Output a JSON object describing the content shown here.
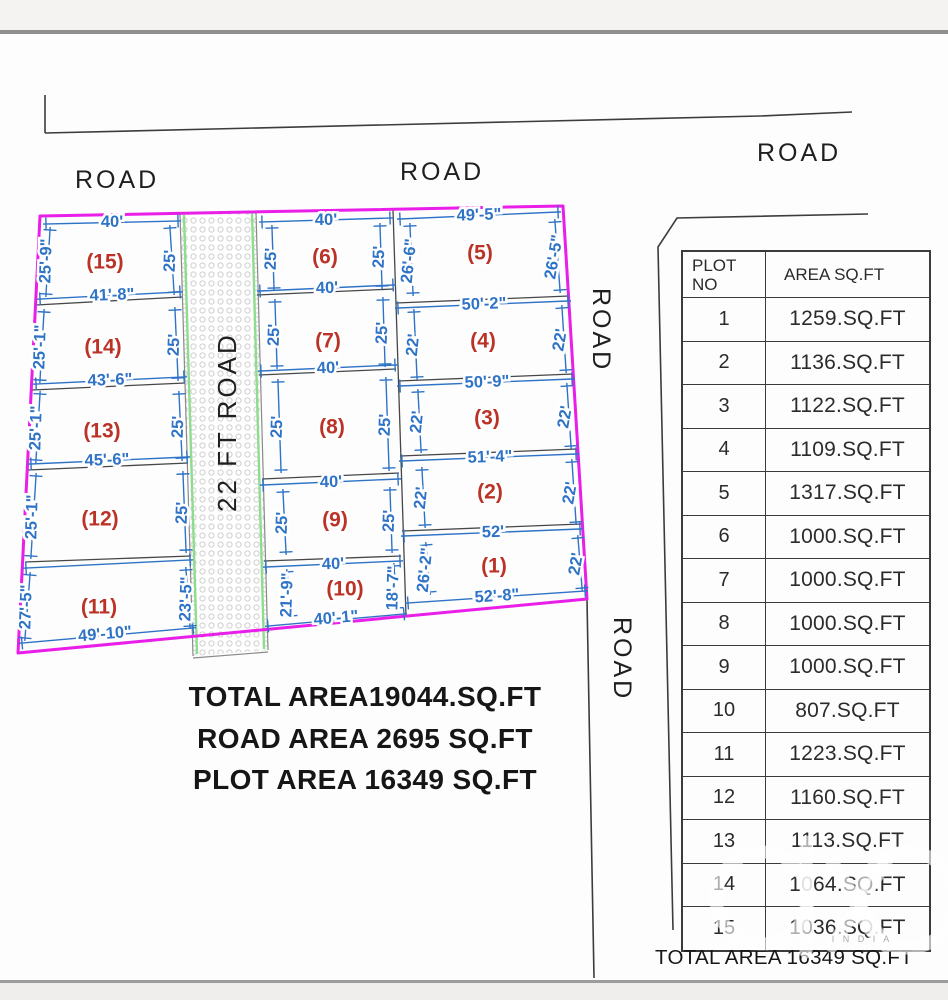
{
  "plan": {
    "road_labels": {
      "top_left": "ROAD",
      "top_center": "ROAD",
      "top_right": "ROAD",
      "right_upper": "ROAD",
      "right_lower": "ROAD",
      "central": "22 FT ROAD"
    },
    "plot_numbers": {
      "p1": "(1)",
      "p2": "(2)",
      "p3": "(3)",
      "p4": "(4)",
      "p5": "(5)",
      "p6": "(6)",
      "p7": "(7)",
      "p8": "(8)",
      "p9": "(9)",
      "p10": "(10)",
      "p11": "(11)",
      "p12": "(12)",
      "p13": "(13)",
      "p14": "(14)",
      "p15": "(15)"
    },
    "dims": {
      "p15_top": "40'",
      "p15_left": "25'-9\"",
      "p15_right": "25'",
      "p15_bottom": "41'-8\"",
      "p14_left": "25'-1\"",
      "p14_right": "25'",
      "p14_bottom": "43'-6\"",
      "p13_left": "25'-1\"",
      "p13_right": "25'",
      "p13_bottom": "45'-6\"",
      "p12_left": "25'-1\"",
      "p12_right": "25'",
      "p11_left": "27'-5\"",
      "p11_right": "23'-5\"",
      "p11_bottom": "49'-10\"",
      "p6_top": "40'",
      "p6_left": "25'",
      "p6_right": "25'",
      "p6_bottom": "40'",
      "p7_left": "25'",
      "p7_right": "25'",
      "p7_bottom": "40'",
      "p8_left": "25'",
      "p8_right": "25'",
      "p8_bottom": "40'",
      "p9_left": "25'",
      "p9_right": "25'",
      "p9_bottom": "40'",
      "p10_left": "21'-9\"",
      "p10_right": "18'-7\"",
      "p10_bottom": "40'-1\"",
      "p5_top": "49'-5\"",
      "p5_left": "26'-6\"",
      "p5_right": "26'-5\"",
      "p5_bottom": "50'-2\"",
      "p4_left": "22'",
      "p4_right": "22'",
      "p4_bottom": "50'-9\"",
      "p3_left": "22'",
      "p3_right": "22'",
      "p3_bottom": "51'-4\"",
      "p2_left": "22'",
      "p2_right": "22'",
      "p2_bottom": "52'",
      "p1_left": "26'-2\"",
      "p1_right": "22'",
      "p1_bottom": "52'-8\""
    }
  },
  "table": {
    "header": {
      "col1": "PLOT NO",
      "col2": "AREA SQ.FT"
    },
    "rows": [
      {
        "no": "1",
        "area": "1259.SQ.FT"
      },
      {
        "no": "2",
        "area": "1136.SQ.FT"
      },
      {
        "no": "3",
        "area": "1122.SQ.FT"
      },
      {
        "no": "4",
        "area": "1109.SQ.FT"
      },
      {
        "no": "5",
        "area": "1317.SQ.FT"
      },
      {
        "no": "6",
        "area": "1000.SQ.FT"
      },
      {
        "no": "7",
        "area": "1000.SQ.FT"
      },
      {
        "no": "8",
        "area": "1000.SQ.FT"
      },
      {
        "no": "9",
        "area": "1000.SQ.FT"
      },
      {
        "no": "10",
        "area": "807.SQ.FT"
      },
      {
        "no": "11",
        "area": "1223.SQ.FT"
      },
      {
        "no": "12",
        "area": "1160.SQ.FT"
      },
      {
        "no": "13",
        "area": "1113.SQ.FT"
      },
      {
        "no": "14",
        "area": "1064.SQ.FT"
      },
      {
        "no": "15",
        "area": "1036.SQ.FT"
      }
    ],
    "total": "TOTAL AREA 16349 SQ.FT"
  },
  "summary": {
    "line1": "TOTAL AREA19044.SQ.FT",
    "line2": "ROAD AREA 2695 SQ.FT",
    "line3": "PLOT AREA 16349 SQ.FT"
  },
  "watermark": {
    "brand": "olx",
    "sub": "I N D I A"
  },
  "colors": {
    "boundary": "#e91ee9",
    "dimension": "#2e73c6",
    "plot_number": "#bb3327",
    "road_edge": "#8fdc8f"
  }
}
